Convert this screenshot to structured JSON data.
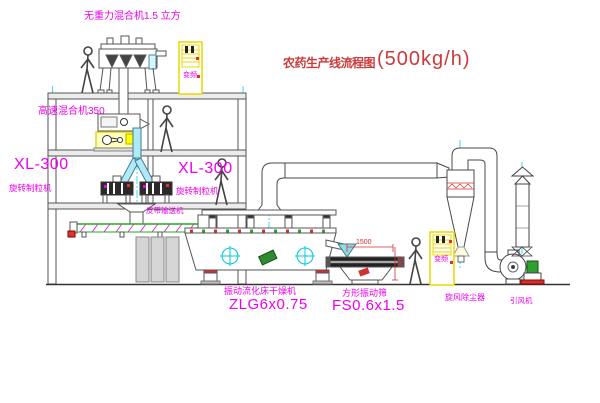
{
  "diagram": {
    "title": {
      "text": "农药生产线流程图",
      "capacity": "(500kg/h)"
    },
    "equipment": {
      "gravity_free_mixer": {
        "label": "无重力混合机1.5 立方"
      },
      "high_speed_mixer": {
        "label": "高速混合机350"
      },
      "granulator_left": {
        "model": "XL-300",
        "name": "旋转制粒机"
      },
      "granulator_right": {
        "model": "XL-300",
        "name": "旋转制粒机"
      },
      "belt_conveyor": {
        "name": "皮带输送机"
      },
      "fluid_bed_dryer": {
        "name": "振动流化床干燥机",
        "model": "ZLG6x0.75"
      },
      "vibrating_screen": {
        "name": "方形振动筛",
        "model": "FS0.6x1.5",
        "dim_width": "1500",
        "dim_height": "540"
      },
      "cyclone": {
        "name": "旋风除尘器"
      },
      "induced_draft_fan": {
        "name": "引风机"
      },
      "control_cabinet_top": {
        "text": "变频"
      },
      "control_cabinet_bottom": {
        "text": "变频"
      }
    },
    "colors": {
      "label_magenta": "#ee00ee",
      "title_red": "#cc3b3b",
      "line_gray": "#555555",
      "centerline_cyan": "#00d8e8",
      "cabinet_yellow": "#e8d800",
      "dimension_red": "#d03030",
      "chute_cyan_fill": "#aeeaf8",
      "motor_green": "#2fa02f"
    }
  }
}
